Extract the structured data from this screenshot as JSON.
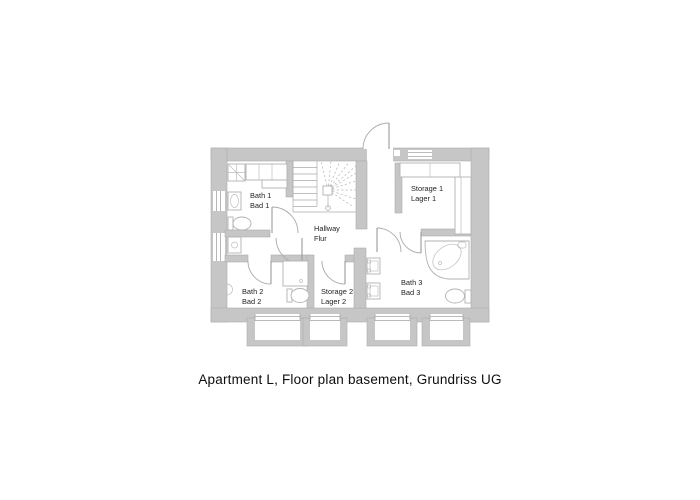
{
  "caption": "Apartment L, Floor plan basement, Grundriss UG",
  "rooms": [
    {
      "id": "bath1",
      "label_en": "Bath 1",
      "label_de": "Bad 1"
    },
    {
      "id": "hallway",
      "label_en": "Hallway",
      "label_de": "Flur"
    },
    {
      "id": "storage1",
      "label_en": "Storage 1",
      "label_de": "Lager 1"
    },
    {
      "id": "bath2",
      "label_en": "Bath 2",
      "label_de": "Bad 2"
    },
    {
      "id": "storage2",
      "label_en": "Storage 2",
      "label_de": "Lager 2"
    },
    {
      "id": "bath3",
      "label_en": "Bath 3",
      "label_de": "Bad 3"
    }
  ],
  "symbols": [
    "staircase-winder-symbol",
    "door-swing-arc",
    "shower-symbol",
    "toilet-symbol",
    "washbasin-symbol",
    "corner-bathtub-symbol",
    "closet-symbol",
    "basement-window-well-symbol"
  ],
  "colors": {
    "background": "#ffffff",
    "wall_fill": "#c6c6c6",
    "wall_outline": "#aeaeae",
    "fixture_line": "#b2b2b2",
    "label_text": "#1f1f1f",
    "caption_text": "#0d0d0d"
  }
}
